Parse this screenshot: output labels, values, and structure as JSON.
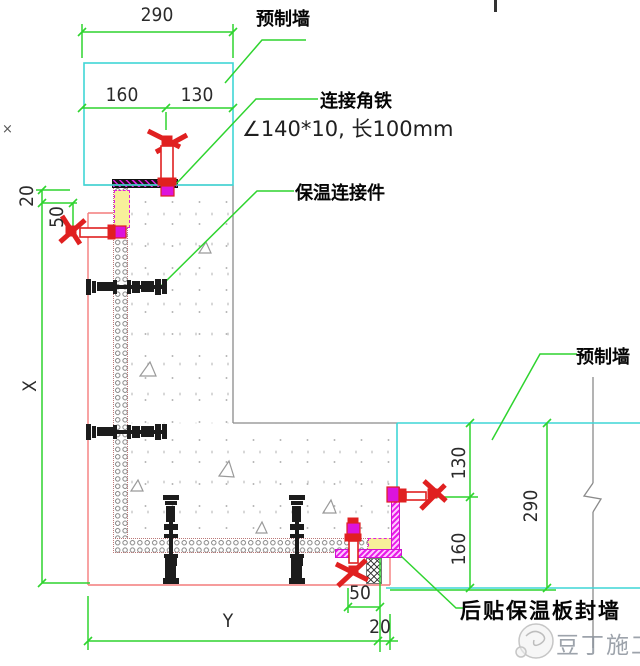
{
  "title": "预制墙转角连接节点详图",
  "labels": {
    "precast_top": "预制墙",
    "angle_iron": "连接角铁",
    "angle_spec": "∠140*10, 长100mm",
    "insulation_connector": "保温连接件",
    "precast_right": "预制墙",
    "seal_wall": "后贴保温板封墙"
  },
  "dimensions": {
    "top_total": "290",
    "top_left": "160",
    "top_right": "130",
    "left_gap": "20",
    "left_offset": "50",
    "left_height": "X",
    "right_upper": "130",
    "right_lower": "160",
    "right_total": "290",
    "bottom_width": "Y",
    "bottom_offset": "50",
    "bottom_gap": "20"
  },
  "watermark": {
    "text": "豆丁施工"
  },
  "stray_mark": "×",
  "colors": {
    "dimension_green": "#2fd42f",
    "wall_cyan": "#3fd6d6",
    "finish_pink": "#f47c7c",
    "fastener_magenta": "#dc14dc",
    "clamp_red": "#e02020",
    "sealant_yellow": "#f7ef9a",
    "line_gray": "#8a8a8a"
  }
}
